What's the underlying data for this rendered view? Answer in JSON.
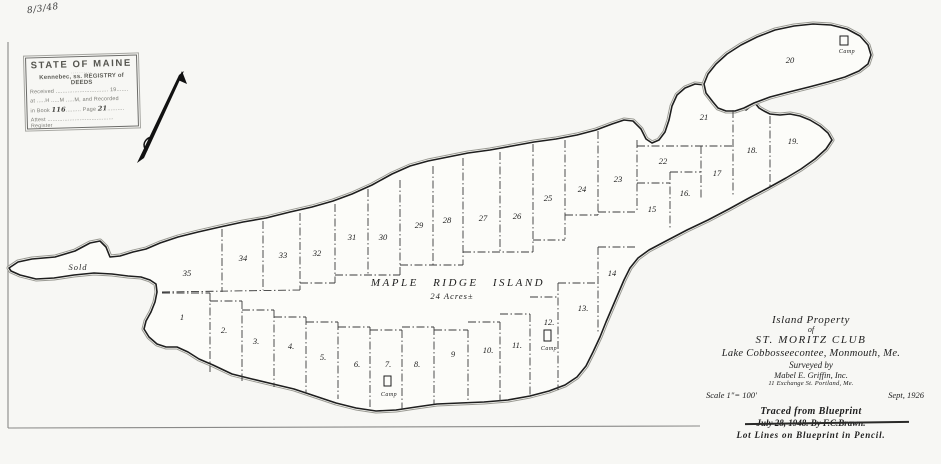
{
  "page": {
    "scan_date_note": "8/3/48"
  },
  "stamp": {
    "state": "STATE OF MAINE",
    "registry": "Kennebec, ss. REGISTRY of DEEDS",
    "received": "Received ............................... 19.......",
    "recorded": "at .....H .....M .....M, and Recorded",
    "book_prefix": "in Book",
    "book_value": "116",
    "page_prefix": "Page",
    "page_value": "21",
    "attest": "Attest ....................................... Register"
  },
  "map": {
    "island_name": "MAPLE RIDGE ISLAND",
    "island_acreage": "24 Acres±",
    "sold_label": "Sold",
    "camp_label": "Camp",
    "lots": [
      {
        "num": "1",
        "x": 182,
        "y": 320
      },
      {
        "num": "2.",
        "x": 224,
        "y": 333
      },
      {
        "num": "3.",
        "x": 256,
        "y": 344
      },
      {
        "num": "4.",
        "x": 291,
        "y": 349
      },
      {
        "num": "5.",
        "x": 323,
        "y": 360
      },
      {
        "num": "6.",
        "x": 357,
        "y": 367
      },
      {
        "num": "7.",
        "x": 388,
        "y": 367
      },
      {
        "num": "8.",
        "x": 417,
        "y": 367
      },
      {
        "num": "9",
        "x": 453,
        "y": 357
      },
      {
        "num": "10.",
        "x": 488,
        "y": 353
      },
      {
        "num": "11.",
        "x": 517,
        "y": 348
      },
      {
        "num": "12.",
        "x": 549,
        "y": 325
      },
      {
        "num": "13.",
        "x": 583,
        "y": 311
      },
      {
        "num": "14",
        "x": 612,
        "y": 276
      },
      {
        "num": "15",
        "x": 652,
        "y": 212
      },
      {
        "num": "16.",
        "x": 685,
        "y": 196
      },
      {
        "num": "17",
        "x": 717,
        "y": 176
      },
      {
        "num": "18.",
        "x": 752,
        "y": 153
      },
      {
        "num": "19.",
        "x": 793,
        "y": 144
      },
      {
        "num": "20",
        "x": 790,
        "y": 63
      },
      {
        "num": "21",
        "x": 704,
        "y": 120
      },
      {
        "num": "22",
        "x": 663,
        "y": 164
      },
      {
        "num": "23",
        "x": 618,
        "y": 182
      },
      {
        "num": "24",
        "x": 582,
        "y": 192
      },
      {
        "num": "25",
        "x": 548,
        "y": 201
      },
      {
        "num": "26",
        "x": 517,
        "y": 219
      },
      {
        "num": "27",
        "x": 483,
        "y": 221
      },
      {
        "num": "28",
        "x": 447,
        "y": 223
      },
      {
        "num": "29",
        "x": 419,
        "y": 228
      },
      {
        "num": "30",
        "x": 383,
        "y": 240
      },
      {
        "num": "31",
        "x": 352,
        "y": 240
      },
      {
        "num": "32",
        "x": 317,
        "y": 256
      },
      {
        "num": "33",
        "x": 283,
        "y": 258
      },
      {
        "num": "34",
        "x": 243,
        "y": 261
      },
      {
        "num": "35",
        "x": 187,
        "y": 276
      }
    ],
    "camps": [
      {
        "x": 384,
        "y": 376,
        "w": 7,
        "h": 10,
        "lx": 389,
        "ly": 396
      },
      {
        "x": 544,
        "y": 330,
        "w": 7,
        "h": 11,
        "lx": 549,
        "ly": 350
      },
      {
        "x": 840,
        "y": 36,
        "w": 8,
        "h": 9,
        "lx": 847,
        "ly": 53
      }
    ]
  },
  "title_block": {
    "line1": "Island Property",
    "line2": "of",
    "line3": "ST. MORITZ CLUB",
    "line4": "Lake Cobbosseecontee, Monmouth, Me.",
    "line5": "Surveyed by",
    "line6": "Mabel E. Griffin, Inc.",
    "line7": "11 Exchange St.    Portland, Me.",
    "scale": "Scale 1\"= 100'",
    "date": "Sept, 1926",
    "traced1": "Traced from Blueprint",
    "traced2": "July 28, 1948.      By F.C.Brawn.",
    "traced3": "Lot Lines on Blueprint in Pencil."
  },
  "colors": {
    "ink": "#1e1e1e",
    "stamp_ink": "#5c5c58",
    "paper": "#f7f7f4"
  }
}
